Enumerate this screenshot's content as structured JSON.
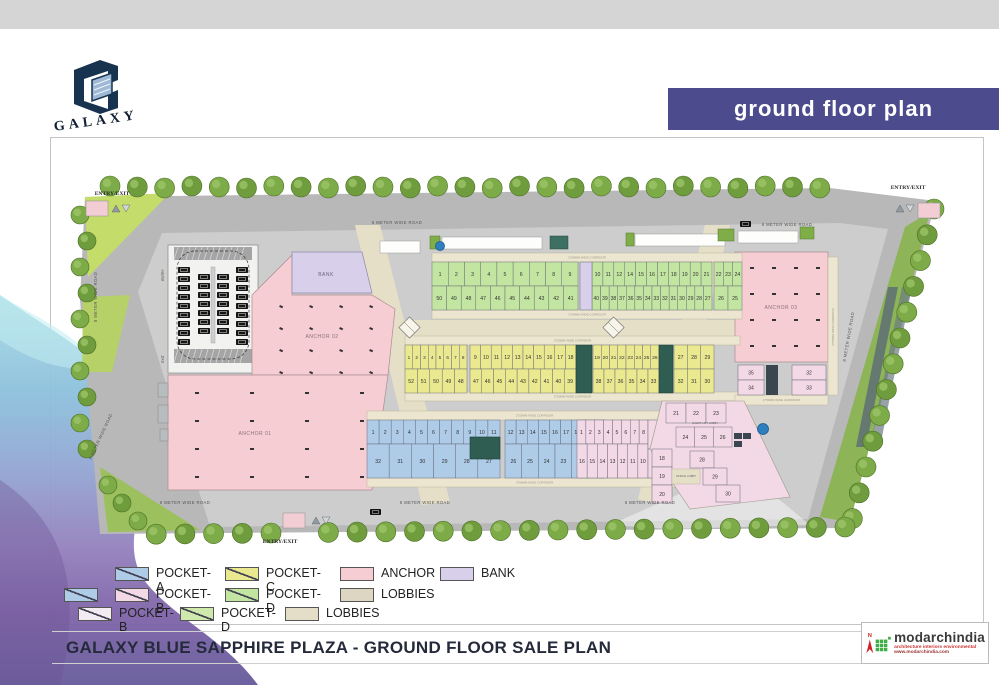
{
  "page": {
    "brand": "GALAXY",
    "banner_title": "ground floor plan",
    "sheet_title": "GALAXY BLUE SAPPHIRE PLAZA - GROUND FLOOR SALE PLAN"
  },
  "colors": {
    "banner": "#4c4b8e",
    "pocketA": "#aecbe8",
    "pocketB": "#f3d9e6",
    "pocketC": "#eae98f",
    "pocketD": "#c3e5a2",
    "anchor": "#f6cdd3",
    "bank": "#d8d0ea",
    "lobbies": "#dcd6c2",
    "road": "#b8b8b8",
    "platform": "#cdcdcd",
    "walkway": "#e6dfc8",
    "corridor": "#ece5cf",
    "grass": "#9cc05e",
    "tree": "#6f9c3c",
    "parking": "#f2f2f0",
    "logo_navy": "#17334f",
    "fountain": "#2d7fbf"
  },
  "legend": {
    "rows": [
      {
        "items": [
          {
            "label": "POCKET-A",
            "color": "#aecbe8",
            "diag": true
          },
          {
            "label": "POCKET-C",
            "color": "#eae98f",
            "diag": true
          },
          {
            "label": "ANCHOR",
            "color": "#f6cdd3",
            "diag": false
          },
          {
            "label": "BANK",
            "color": "#d8d0ea",
            "diag": false
          }
        ]
      },
      {
        "items": [
          {
            "label": "",
            "color": "#aecbe8",
            "diag": true
          },
          {
            "label": "POCKET-B",
            "color": "#f3d9e6",
            "diag": true
          },
          {
            "label": "POCKET-D",
            "color": "#c3e5a2",
            "diag": true
          },
          {
            "label": "LOBBIES",
            "color": "#dcd6c2",
            "diag": false
          }
        ]
      },
      {
        "items": [
          {
            "label": "POCKET-B",
            "color": "#f2ecf2",
            "diag": true
          },
          {
            "label": "POCKET-D",
            "color": "#cfe9ac",
            "diag": true
          },
          {
            "label": "LOBBIES",
            "color": "#e4ddc8",
            "diag": false
          }
        ]
      }
    ]
  },
  "plan": {
    "entries": {
      "top_left": "ENTRY/EXIT",
      "top_right": "ENTRY/EXIT",
      "bottom": "ENTRY/EXIT"
    },
    "roads": {
      "h": "6 METER WIDE ROAD",
      "v": "8 METER WIDE ROAD"
    },
    "labels": {
      "anchor01": "ANCHOR 01",
      "anchor02": "ANCHOR 02",
      "anchor03": "ANCHOR 03",
      "bank": "BANK",
      "corridor": "2750MM WIDE CORRIDOR",
      "guest_lobby": "GUEST LIFT LOBBY",
      "office_lobby": "OFFICE LOBBY",
      "parking_entry": "ENTRY",
      "parking_exit": "EXIT"
    },
    "units": {
      "pocketD": {
        "leftTop": [
          "1",
          "2",
          "3",
          "4",
          "5",
          "6",
          "7",
          "8",
          "9"
        ],
        "leftBottom": [
          "50",
          "49",
          "48",
          "47",
          "46",
          "45",
          "44",
          "43",
          "42",
          "41"
        ],
        "rightTop": [
          "10",
          "11",
          "12",
          "14",
          "15",
          "16",
          "17",
          "18",
          "19",
          "20",
          "21"
        ],
        "rightBottom": [
          "40",
          "39",
          "38",
          "37",
          "36",
          "35",
          "34",
          "33",
          "32",
          "31",
          "30",
          "29",
          "28",
          "27"
        ],
        "endTop": [
          "22",
          "23",
          "24"
        ],
        "endBottom": [
          "26",
          "25"
        ]
      },
      "pocketC": {
        "leftTop": [
          "1",
          "2",
          "3",
          "4",
          "5",
          "6",
          "7",
          "8"
        ],
        "leftBottom": [
          "52",
          "51",
          "50",
          "49",
          "48"
        ],
        "midTop": [
          "9",
          "10",
          "11",
          "12",
          "13",
          "14",
          "15",
          "16",
          "17",
          "18"
        ],
        "midBottom": [
          "47",
          "46",
          "45",
          "44",
          "43",
          "42",
          "41",
          "40",
          "39"
        ],
        "rightTop": [
          "19",
          "20",
          "21",
          "22",
          "23",
          "24",
          "25",
          "26"
        ],
        "rightBottom": [
          "38",
          "37",
          "36",
          "35",
          "34",
          "33"
        ],
        "endTop": [
          "27",
          "28",
          "29"
        ],
        "endBottom": [
          "32",
          "31",
          "30"
        ]
      },
      "pocketA": {
        "leftTop": [
          "1",
          "2",
          "3",
          "4",
          "5",
          "6",
          "7",
          "8",
          "9",
          "10",
          "11"
        ],
        "leftBottom": [
          "32",
          "31",
          "30",
          "29",
          "28",
          "27"
        ],
        "midTop": [
          "12",
          "13",
          "14",
          "15",
          "16",
          "17",
          "18",
          "19",
          "20"
        ],
        "midBottom": [
          "26",
          "25",
          "24",
          "23",
          "22",
          "21"
        ]
      },
      "pocketB": {
        "leftTop": [
          "1",
          "2",
          "3",
          "4",
          "5",
          "6",
          "7",
          "8"
        ],
        "leftBottom": [
          "16",
          "15",
          "14",
          "13",
          "12",
          "11",
          "10"
        ],
        "sideTop": "9",
        "sideBottom": "17",
        "rightTop": [
          "21",
          "22",
          "23"
        ],
        "rightMid": [
          "24",
          "25",
          "26"
        ],
        "rightDiag": [
          "28",
          "29",
          "30"
        ],
        "rightCol": [
          "18",
          "19",
          "20"
        ],
        "anchorSide": [
          "35",
          "34",
          "32",
          "33"
        ]
      }
    }
  },
  "footer": {
    "credit_name": "modarchindia",
    "credit_tagline": "architecture  interiors  environmental",
    "credit_url": "www.modarchindia.com",
    "north": "N"
  }
}
